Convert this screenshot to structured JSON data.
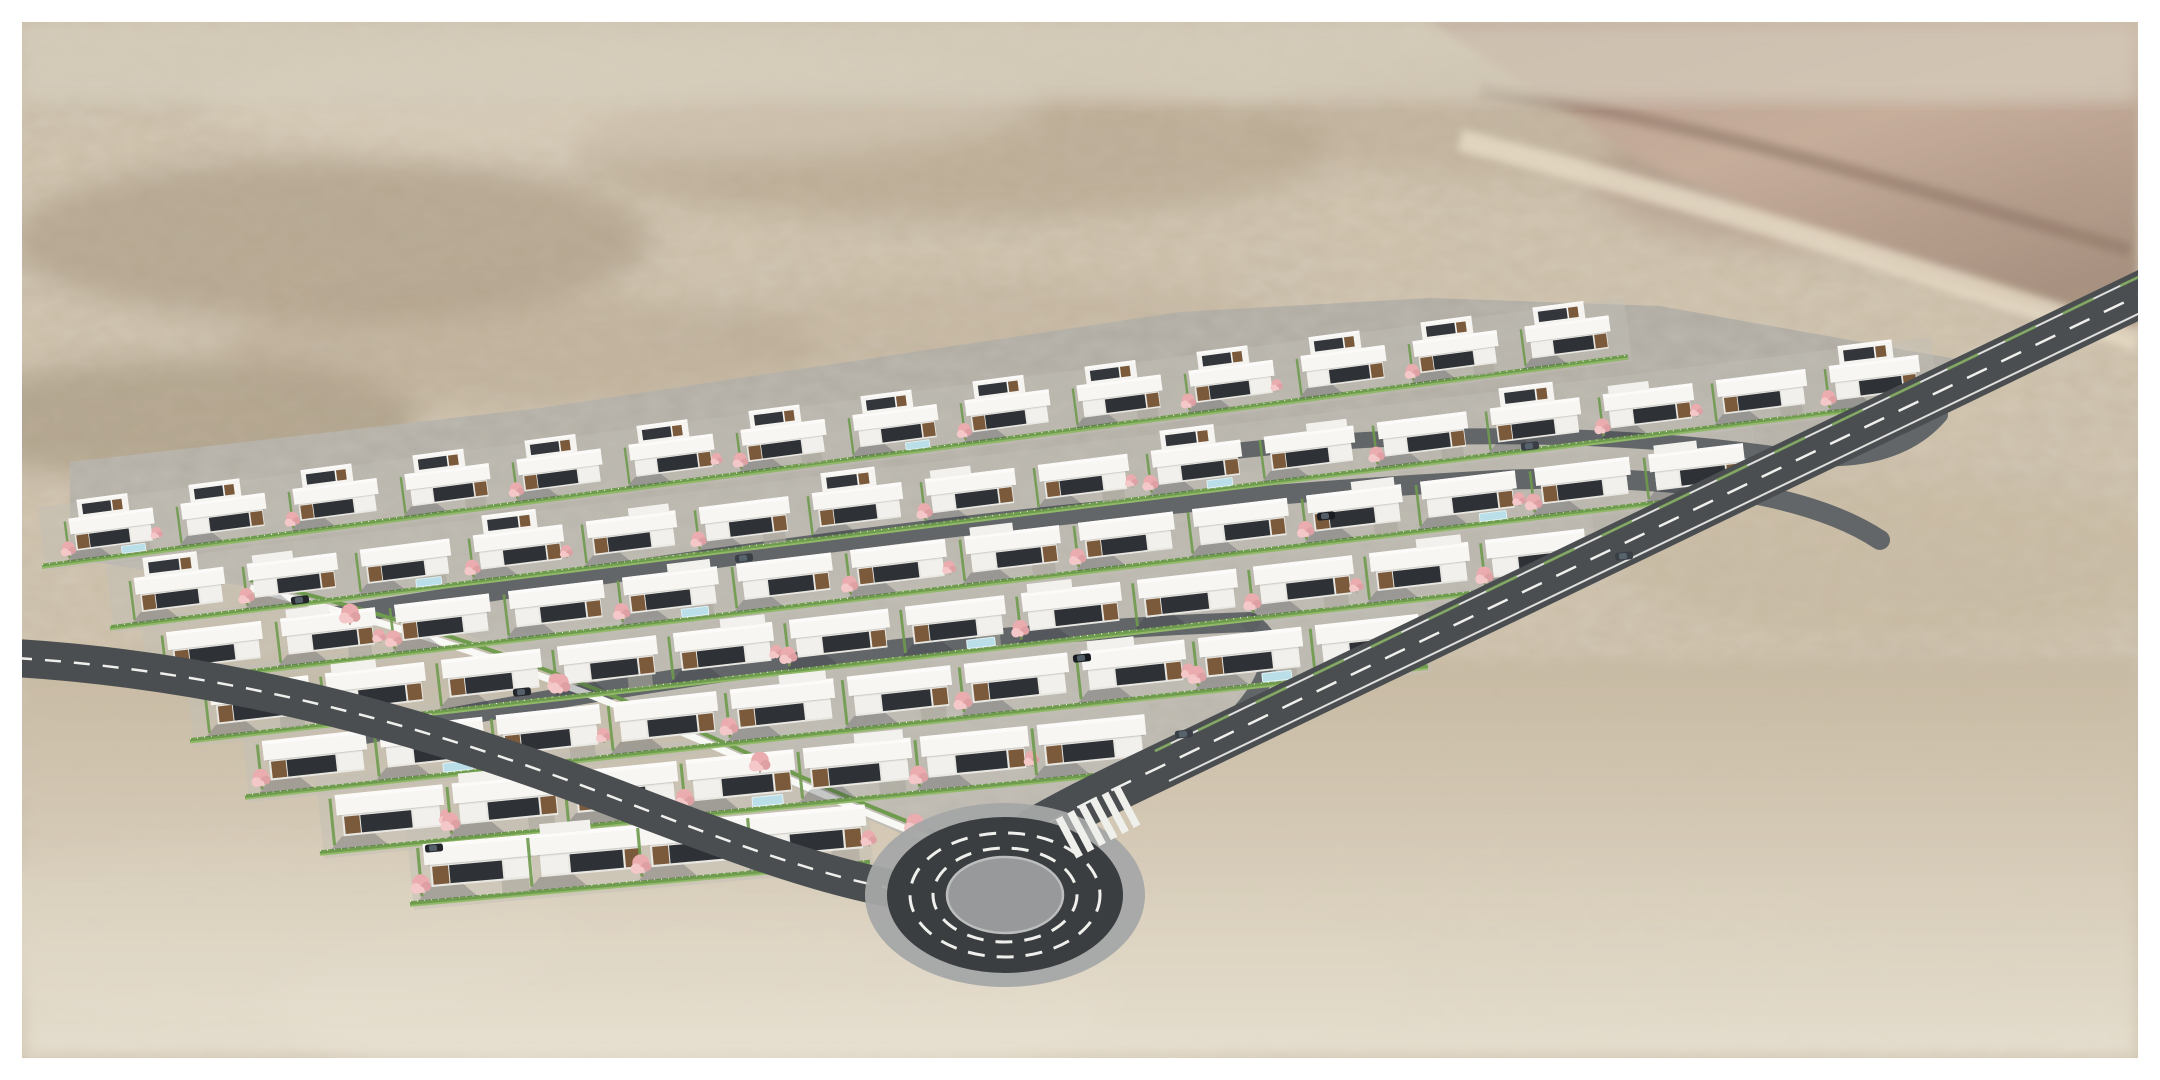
{
  "meta": {
    "description": "Aerial 3D architectural rendering of a residential estate of white flat-roof villas with dark wood accents, pink blossom trees and green hedges on grey paved plots, set in a blurred sandy desert landscape, served by perimeter roads and a roundabout with a zebra crossing."
  },
  "frame": {
    "border_px": 22,
    "color": "#ffffff"
  },
  "palette": {
    "sand_base": "#cbbda6",
    "sand_dark": "#8f8068",
    "sand_light": "#e6ddcc",
    "road_asphalt": "#4a4e51",
    "roundabout_asphalt": "#3b3e41",
    "roundabout_apron": "#a4a6a6",
    "roundabout_island": "#97999b",
    "road_marking": "#efefec",
    "internal_road": "#5d6164",
    "terrace": "#c2bfb6",
    "house_roof": "#f7f6f2",
    "house_roof_edge": "#fcfbf9",
    "house_wall": "#e9e7e2",
    "house_wing": "#f3f1ed",
    "window_dark": "#2e3236",
    "wood_accent": "#7b5a3b",
    "hedge_green": "#6f9b4e",
    "hedge_light": "#94bd6a",
    "hedge_speckle": "#eef6e3",
    "tree_pink": "#eaacae",
    "tree_pink_light": "#f4c8c9",
    "tree_pink_dark": "#dfa0a4",
    "trunk_brown": "#8a6a52",
    "pool_blue": "#badfe8",
    "pool_rim": "#e4f2f6",
    "wall_white": "#f8f8f5",
    "car_colors": [
      "#23262b",
      "#3a3f46",
      "#191c20"
    ],
    "shadow": "rgba(45,48,58,0.25)"
  },
  "desert": {
    "patches": [
      [
        330,
        240,
        320,
        80,
        "#a2917a",
        0.5
      ],
      [
        950,
        150,
        380,
        70,
        "#ab9a81",
        0.45
      ],
      [
        1550,
        120,
        300,
        60,
        "#b4a28b",
        0.4
      ],
      [
        180,
        420,
        240,
        60,
        "#97876f",
        0.45
      ],
      [
        620,
        100,
        420,
        60,
        "#dbd1bf",
        0.5
      ],
      [
        520,
        350,
        300,
        55,
        "#ad9c84",
        0.35
      ],
      [
        1000,
        330,
        280,
        50,
        "#b6a58d",
        0.3
      ],
      [
        1850,
        180,
        260,
        70,
        "#a98f80",
        0.5
      ],
      [
        2030,
        120,
        200,
        60,
        "#bda592",
        0.45
      ],
      [
        1450,
        430,
        240,
        60,
        "#c0ae96",
        0.35
      ],
      [
        1900,
        560,
        280,
        80,
        "#c4b49c",
        0.4
      ],
      [
        2000,
        800,
        300,
        100,
        "#cfc1a9",
        0.45
      ],
      [
        1500,
        950,
        420,
        110,
        "#d4c7b1",
        0.5
      ],
      [
        700,
        1000,
        420,
        100,
        "#e9e2d3",
        0.55
      ],
      [
        250,
        930,
        320,
        90,
        "#ece5d7",
        0.5
      ],
      [
        1100,
        980,
        300,
        80,
        "#ddd2bf",
        0.4
      ]
    ],
    "ridge_points": "1430,22 2138,22 2138,340 1900,270 1640,160",
    "ridge_highlight": "M 1460,140 C 1700,200 1950,280 2138,340",
    "ridge_streak": "M 1480,90 C 1700,120 1950,200 2130,250",
    "haze": [
      22,
      22,
      2116,
      80
    ],
    "foreground": [
      22,
      660,
      2116,
      398
    ]
  },
  "estate": {
    "outline": "70,462 540,408 1180,312 1430,298 1660,306 1995,366 1583,566 1299,700 1183,756 1075,816 1000,845 930,846 800,790 640,706 470,636 280,592 70,558",
    "wall_path": "M 250,588 C 430,632 560,680 700,740 C 790,780 870,816 950,846",
    "rows": [
      {
        "x": 112,
        "y": 525,
        "slope": -0.132,
        "count": 14,
        "dx": 112,
        "scale": 0.8,
        "two_story": "all"
      },
      {
        "x": 180,
        "y": 585,
        "slope": -0.125,
        "count": 16,
        "dx": 113,
        "scale": 0.85,
        "two_story": "some"
      },
      {
        "x": 215,
        "y": 640,
        "slope": -0.12,
        "count": 14,
        "dx": 114,
        "scale": 0.9,
        "two_story": "none"
      },
      {
        "x": 260,
        "y": 695,
        "slope": -0.115,
        "count": 12,
        "dx": 116,
        "scale": 0.94,
        "two_story": "none"
      },
      {
        "x": 315,
        "y": 750,
        "slope": -0.11,
        "count": 10,
        "dx": 117,
        "scale": 0.98,
        "two_story": "none"
      },
      {
        "x": 390,
        "y": 805,
        "slope": -0.1,
        "count": 7,
        "dx": 117,
        "scale": 1.02,
        "two_story": "none"
      },
      {
        "x": 480,
        "y": 855,
        "slope": -0.09,
        "count": 4,
        "dx": 110,
        "scale": 1.06,
        "two_story": "none"
      }
    ],
    "standalone_trees": [
      [
        350,
        618
      ],
      [
        560,
        688
      ],
      [
        760,
        766
      ],
      [
        915,
        828
      ]
    ]
  },
  "roads": {
    "left": {
      "path": "M 16,658 C 240,672 440,730 620,800 C 740,846 820,876 900,890",
      "width": 38,
      "dash": "16 13"
    },
    "right": {
      "path": "M 2158,286 L 1162,766 C 1122,785 1076,807 1036,830",
      "width": 46,
      "dash": "22 16",
      "edge1": "M 2165,301 L 1169,781",
      "edge2": "M 2151,271 L 1155,751"
    },
    "internal": [
      {
        "path": "M 300,622 C 700,556 1100,500 1500,480 C 1700,472 1820,500 1880,540",
        "width": 20
      },
      {
        "path": "M 360,735 C 700,668 1000,630 1250,622",
        "width": 20
      },
      {
        "path": "M 1250,622 C 1300,650 1250,730 1150,776",
        "width": 18
      },
      {
        "path": "M 1200,455 C 1400,430 1600,430 1780,455 C 1860,466 1910,450 1940,415",
        "width": 16
      }
    ]
  },
  "roundabout": {
    "cx": 1005,
    "cy": 895,
    "apron": [
      140,
      92
    ],
    "asphalt": [
      118,
      78
    ],
    "lane_dashes": [
      [
        95,
        62
      ],
      [
        72,
        47
      ]
    ],
    "dash_pattern": "17 12",
    "island": [
      58,
      38
    ]
  },
  "crosswalk": {
    "cx": 1098,
    "cy": 822,
    "dir": [
      0.883,
      -0.469
    ],
    "stripes": 6,
    "spacing": 13,
    "length": 44,
    "stripe_width": 7.5
  },
  "cars": [
    [
      300,
      600,
      -7,
      0
    ],
    [
      744,
      558,
      -7,
      1
    ],
    [
      1326,
      516,
      -6,
      2
    ],
    [
      1530,
      446,
      -7,
      1
    ],
    [
      522,
      692,
      -6,
      0
    ],
    [
      1082,
      658,
      -6,
      2
    ],
    [
      1624,
      556,
      -6,
      1
    ],
    [
      434,
      848,
      -5,
      0
    ],
    [
      1184,
      734,
      -6,
      1
    ]
  ]
}
